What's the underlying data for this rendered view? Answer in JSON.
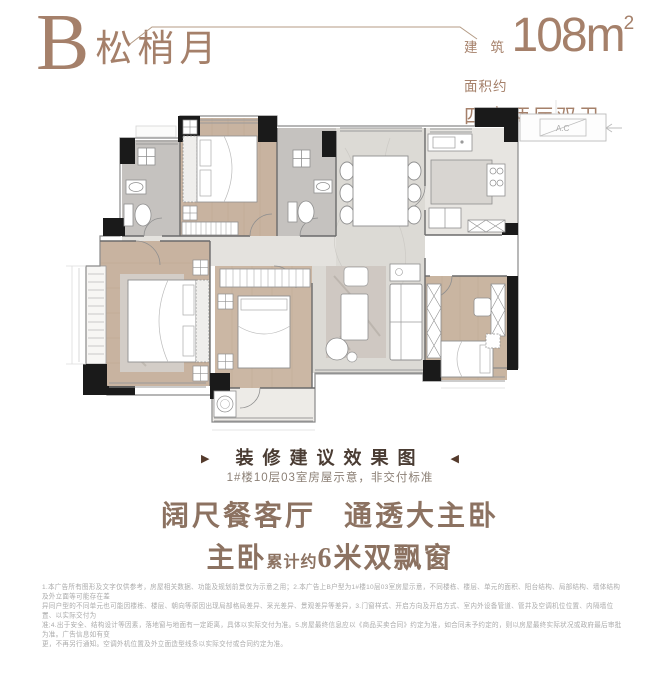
{
  "colors": {
    "accent": "#a5806a",
    "caption_title": "#4a3c33",
    "arrow": "#543a2b",
    "slogan": "#8c7261",
    "subtitle": "#8c8076",
    "disclaimer": "#aaaaaa",
    "wall": "#1a1a1a",
    "wood_floor": "#c8b3a0",
    "marble_floor": "#dcdad5"
  },
  "header": {
    "unit_letter": "B",
    "unit_name": "松梢月",
    "area_label_line1_a": "建",
    "area_label_line1_b": "筑",
    "area_label_line2": "面积约",
    "area_value": "108m",
    "area_sup": "2",
    "spec": "四房两厅双卫"
  },
  "plan": {
    "ac_label": "A.C"
  },
  "caption": {
    "left_arrow": "▶",
    "right_arrow": "◀",
    "title": "装修建议效果图",
    "subtitle": "1#楼10层03室房屋示意，非交付标准"
  },
  "slogan": {
    "line1_left": "阔尺餐客厅",
    "line1_right": "通透大主卧",
    "line2_big1": "主卧",
    "line2_small": "累计约",
    "line2_big2": "6米双飘窗"
  },
  "disclaimer": {
    "lines": [
      "1.本广告所有图形及文字仅供参考，房屋相关数据、功能及规划前景仅为示意之用；2.本广告上B户型为1#楼10层03室房屋示意，不同楼栋、楼层、单元的面积、阳台结构、局部结构、墙体结构及外立面等可能存在差",
      "异同户型的不同单元也可能因楼栋、楼层、朝向等原因出现局部格局差异、采光差异、景观差异等差异，3.门窗样式、开启方向及开启方式、室内外设备管道、管井及空调机位位置、内隔墙位置、以实际交付为",
      "准;4.出于安全、结构设计等因素，落地窗与地面有一定距离，具体以实际交付为准。5.房屋最终信息应以《商品买卖合同》约定为准，如合同未予约定的，则以房屋最终实际状况或政府最后审批为准。广告信息如有变",
      "更，不再另行通知。空调外机位置及外立面造型线条以实际交付或合同约定为准。"
    ]
  }
}
